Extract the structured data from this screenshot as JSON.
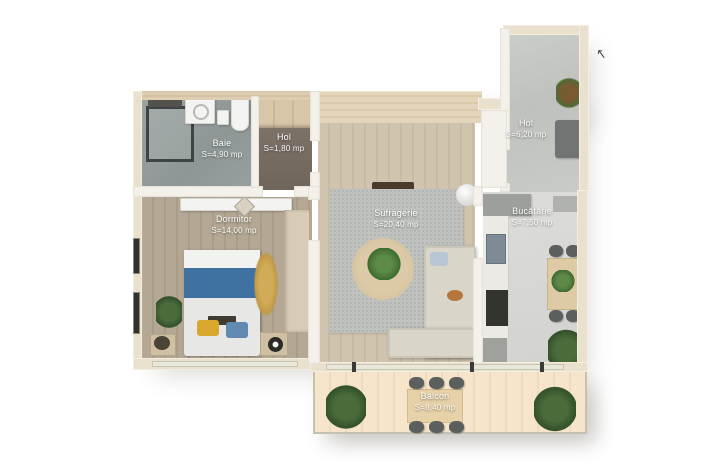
{
  "rooms": {
    "baie": {
      "name": "Baie",
      "area": "S=4,90 mp"
    },
    "hol_mic": {
      "name": "Hol",
      "area": "S=1,80 mp"
    },
    "hol_intrare": {
      "name": "Hol",
      "area": "S=6,20 mp"
    },
    "dormitor": {
      "name": "Dormitor",
      "area": "S=14,00 mp"
    },
    "sufragerie": {
      "name": "Sufragerie",
      "area": "S=20,40 mp"
    },
    "bucatarie": {
      "name": "Bucătărie",
      "area": "S=7,50 mp"
    },
    "balcon": {
      "name": "Balcon",
      "area": "S=8,40 mp"
    }
  },
  "icons": {
    "north_arrow": "↖"
  },
  "colors": {
    "background": "#ffffff",
    "outer_wall": "#e9e1ce",
    "bath_floor": "#96a09e",
    "small_hall_floor": "#756a60",
    "entry_floor": "#c6c8c4",
    "living_floor": "#cfc3ae",
    "bedroom_floor": "#b2a592",
    "kitchen_floor": "#d8d8d4",
    "balcony_floor": "#f3e1c6",
    "bed_blanket_blue": "#3f72a0",
    "plant_green": "#4c7c3f"
  }
}
